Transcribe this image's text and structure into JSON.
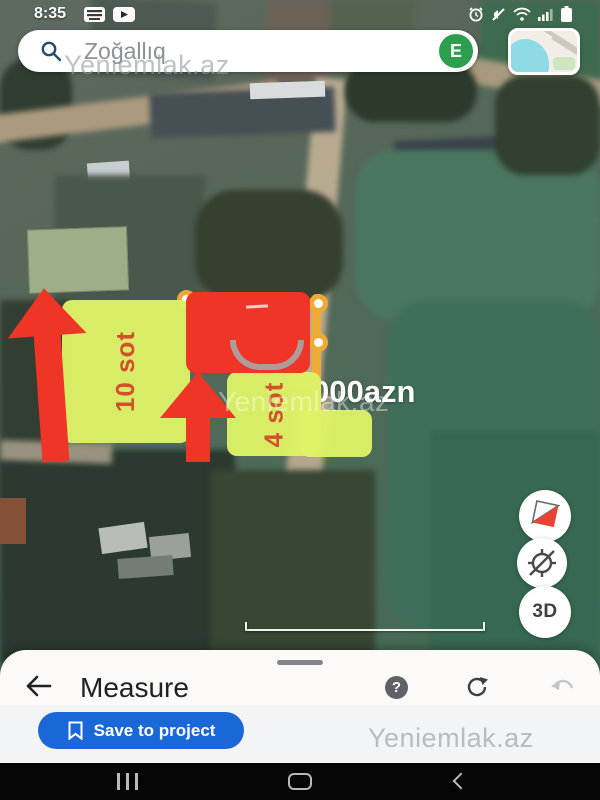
{
  "status_bar": {
    "time": "8:35",
    "left_icons": [
      "keyboard-icon",
      "youtube-icon"
    ],
    "right_icons": [
      "alarm-icon",
      "mute-icon",
      "wifi-icon",
      "signal-icon",
      "battery-icon"
    ]
  },
  "search": {
    "query": "Zoğallıq",
    "avatar_letter": "E"
  },
  "watermarks": {
    "search": "Yeniemlak.az",
    "map": "Yeniemlak.az",
    "footer": "Yeniemlak.az"
  },
  "overlays": {
    "plots": [
      {
        "label": "10 sot"
      },
      {
        "label": "4 sot"
      }
    ],
    "price": "000azn"
  },
  "map_controls": {
    "compass": "compass-icon",
    "location": "location-off-icon",
    "threed": "3D"
  },
  "scale": {
    "label": "40 m"
  },
  "bottom_sheet": {
    "title": "Measure",
    "help": "?",
    "save_label": "Save to project"
  },
  "colors": {
    "overlay-red": "#ef3526",
    "overlay-lime": "#ddf266",
    "label-red": "#d7502a",
    "measure-yellow": "#efa935",
    "save-blue": "#1a67d8",
    "avatar-green": "#2d9d4e"
  }
}
